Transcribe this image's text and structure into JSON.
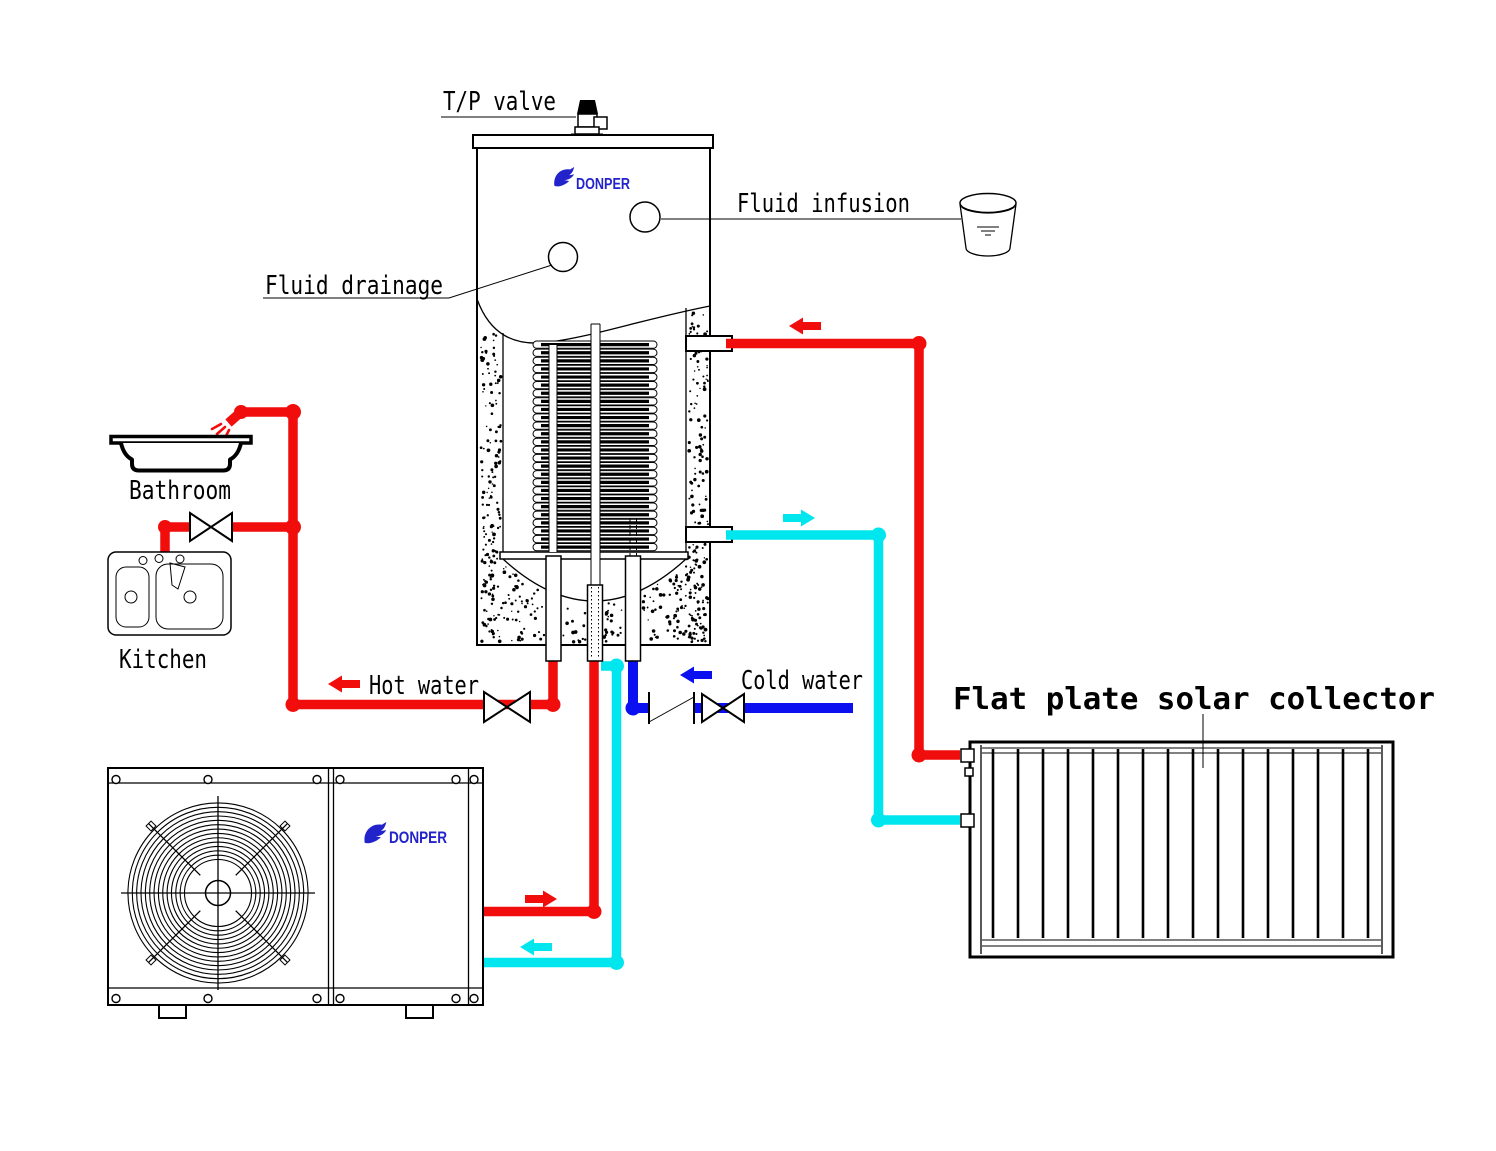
{
  "labels": {
    "tp_valve": "T/P valve",
    "fluid_infusion": "Fluid infusion",
    "fluid_drainage": "Fluid drainage",
    "bathroom": "Bathroom",
    "kitchen": "Kitchen",
    "hot_water": "Hot water",
    "cold_water": "Cold water",
    "solar_collector_title": "Flat plate solar collector"
  },
  "brand": {
    "name": "DONPER",
    "color": "#2323cb"
  },
  "colors": {
    "hot": "#f20d0d",
    "cool": "#00e6ee",
    "cold": "#0a10f0",
    "line": "#000000",
    "background": "#ffffff"
  },
  "diagram": {
    "coil": {
      "loops": 26,
      "x": 533,
      "width": 124,
      "y": 341,
      "pitch": 8.1,
      "height": 7.3
    },
    "collector": {
      "fins": 16,
      "fin_x0": 993,
      "fin_dx": 25,
      "fin_y0": 749,
      "fin_y1": 938
    },
    "fan": {
      "cx": 218,
      "cy": 893,
      "hub_r": 12.5,
      "ring_r0": 33.5,
      "ring_dr": 4.35,
      "rings": 14
    },
    "screws": {
      "xs": [
        116,
        208,
        317,
        340,
        456,
        474
      ],
      "rows": [
        779.5,
        998.5
      ],
      "r": 4
    },
    "stipple": {
      "seed": 11,
      "left": 150,
      "right": 160,
      "bottom": 230
    }
  }
}
